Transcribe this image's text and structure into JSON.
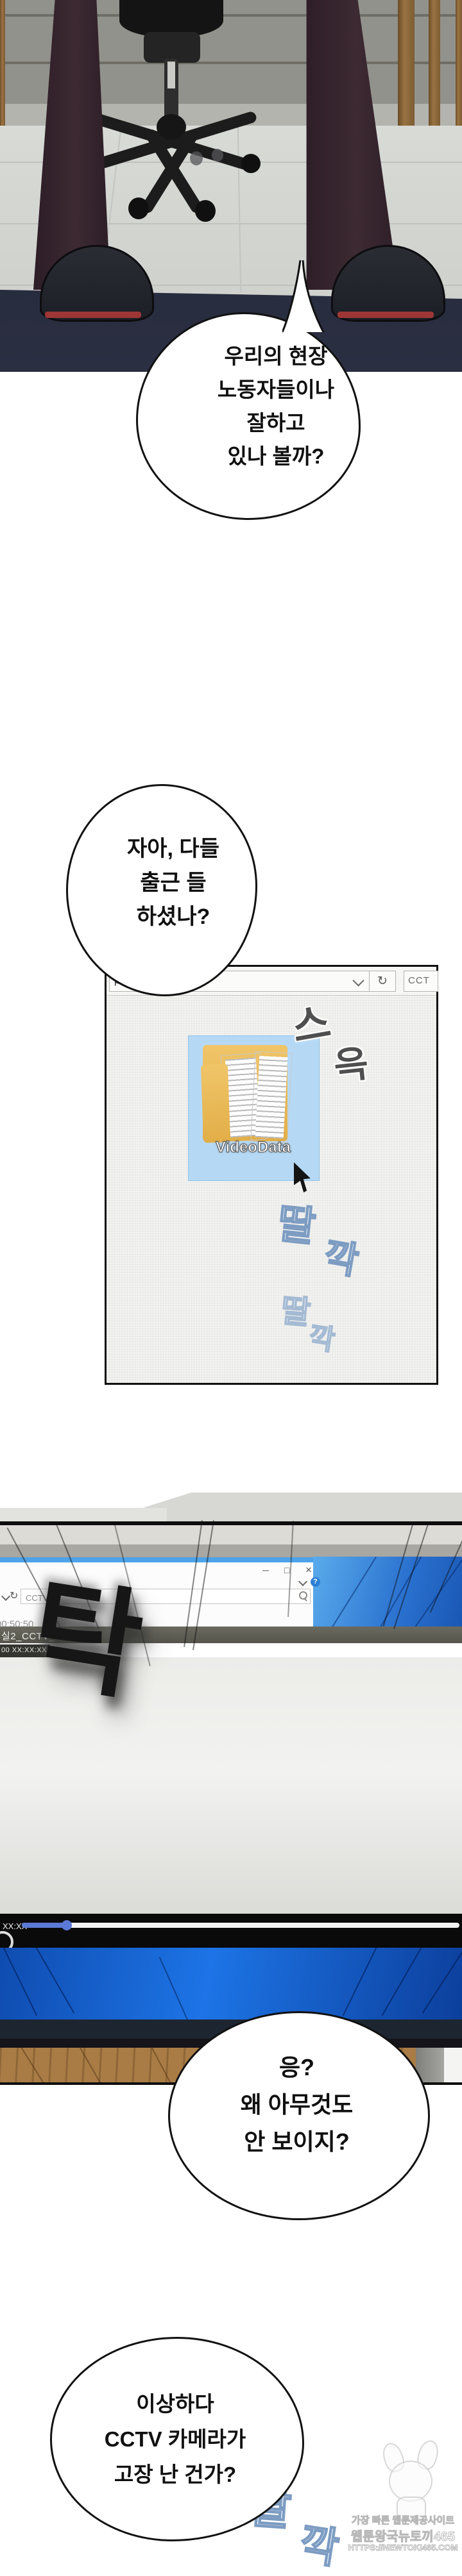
{
  "bubble1": {
    "lines": [
      "우리의 현장",
      "노동자들이나",
      "잘하고",
      "있나 볼까?"
    ]
  },
  "bubble2": {
    "lines": [
      "자아, 다들",
      "출근 들",
      "하셨나?"
    ]
  },
  "bubble4": {
    "lines": [
      "응?",
      "왜 아무것도",
      "안 보이지?"
    ]
  },
  "bubble5": {
    "lines": [
      "이상하다",
      "CCTV 카메라가",
      "고장 난 건가?"
    ]
  },
  "explorer": {
    "address_text": "pc,cc",
    "search_text": "CCT",
    "folder_label": "VideoData"
  },
  "monitor": {
    "window": {
      "minimize": "─",
      "maximize": "□",
      "close": "×",
      "help": "?"
    },
    "toolbar": {
      "search_text": "CCTV 검"
    },
    "partial_time": "00:50:50",
    "video_title": "실2_CCTV_02",
    "timestamp_overlay": "00 XX:XX:XX",
    "player": {
      "time_label": "XX:XX",
      "progress_percent": 10
    }
  },
  "sfx": {
    "slide": {
      "char1": "스",
      "char2": "윽"
    },
    "click1": {
      "char1": "딸",
      "char2": "깍"
    },
    "click2": {
      "char1": "딸",
      "char2": "깍"
    },
    "click3": {
      "char1": "딸",
      "char2": "깍"
    },
    "tak": "탁"
  },
  "icons": {
    "refresh": "↻"
  },
  "watermark": {
    "line1": "가장 빠른 웹툰제공사이트",
    "line2": "웹툰왕국뉴토끼465",
    "line3": "HTTPS://NEWTOKI465.COM"
  },
  "colors": {
    "selection_blue": "#b5d9f5",
    "desktop_blue": "#1d74e6",
    "progress_blue": "#5b79d6",
    "folder_yellow": "#e8b84a",
    "sole_red": "#9e3636"
  }
}
